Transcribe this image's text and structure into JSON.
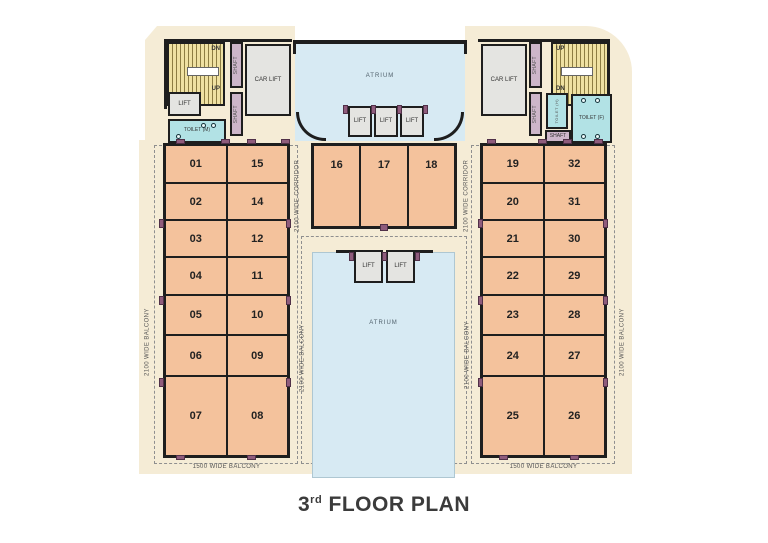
{
  "title": {
    "number": "3",
    "ordinal": "rd",
    "text": " FLOOR PLAN"
  },
  "labels": {
    "atrium": "ATRIUM",
    "lift": "LIFT",
    "car_lift": "CAR LIFT",
    "shaft": "SHAFT",
    "toilet_m": "TOILET (M)",
    "toilet_f": "TOILET (F)",
    "toilet_h": "TOILET (H)",
    "up": "UP",
    "dn": "DN",
    "corridor_2100": "2100 WIDE CORRIDOR",
    "balcony_2100": "2100 WIDE BALCONY",
    "balcony_1500": "1500 WIDE BALCONY"
  },
  "units": {
    "left_col1": [
      "01",
      "02",
      "03",
      "04",
      "05",
      "06",
      "07"
    ],
    "left_col2": [
      "15",
      "14",
      "12",
      "11",
      "10",
      "09",
      "08"
    ],
    "center": [
      "16",
      "17",
      "18"
    ],
    "right_col1": [
      "19",
      "20",
      "21",
      "22",
      "23",
      "24",
      "25"
    ],
    "right_col2": [
      "32",
      "31",
      "30",
      "29",
      "28",
      "27",
      "26"
    ]
  },
  "colors": {
    "cream": "#f5ecd6",
    "unit_fill": "#f4c29c",
    "atrium_fill": "#d7eaf3",
    "stair_fill": "#efe1a2",
    "toilet_fill": "#b2e2e5",
    "lift_fill": "#e4e4e1",
    "shaft_fill": "#cdb6ca",
    "wall": "#1e1e1e",
    "marker": "#8f5c7c"
  }
}
